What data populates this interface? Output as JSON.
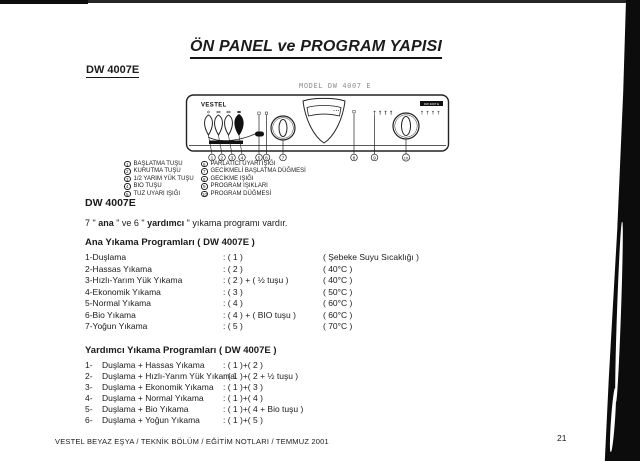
{
  "page": {
    "title": "ÖN PANEL ve PROGRAM YAPISI",
    "doc_model": "DW 4007E",
    "footer_text": "VESTEL BEYAZ EŞYA / TEKNİK BÖLÜM / EĞİTİM NOTLARI / TEMMUZ 2001",
    "page_number": "21"
  },
  "panel_figure": {
    "model_label": "MODEL DW 4007 E",
    "brand": "VESTEL",
    "badge": "DW 4007 E",
    "callout_numbers": [
      "1",
      "2",
      "3",
      "4",
      "5",
      "6",
      "7",
      "8",
      "9",
      "10"
    ],
    "legend_left": [
      {
        "num": "1",
        "label": "BAŞLATMA TUŞU"
      },
      {
        "num": "2",
        "label": "KURUTMA TUŞU"
      },
      {
        "num": "3",
        "label": "1/2 YARIM YÜK TUŞU"
      },
      {
        "num": "4",
        "label": "BIO TUŞU"
      },
      {
        "num": "5",
        "label": "TUZ UYARI IŞIĞI"
      }
    ],
    "legend_right": [
      {
        "num": "6",
        "label": "PARLATICI UYARI IŞIĞI"
      },
      {
        "num": "7",
        "label": "GECİKMELİ BAŞLATMA DÜĞMESİ"
      },
      {
        "num": "8",
        "label": "GECİKME IŞIĞI"
      },
      {
        "num": "9",
        "label": "PROGRAM IŞIKLARI"
      },
      {
        "num": "10",
        "label": "PROGRAM DÜĞMESİ"
      }
    ]
  },
  "intro": {
    "model": "DW 4007E",
    "line_parts": {
      "p1": "7 \" ",
      "b1": "ana",
      "p2": " \" ve 6 \" ",
      "b2": "yardımcı",
      "p3": " \"  yıkama programı vardır."
    }
  },
  "main_programs": {
    "heading": "Ana Yıkama Programları   ( DW 4007E )",
    "rows": [
      {
        "name": "1-Duşlama",
        "code": ": ( 1 )",
        "temp": "( Şebeke Suyu Sıcaklığı )"
      },
      {
        "name": "2-Hassas Yıkama",
        "code": ": ( 2 )",
        "temp": "( 40°C )"
      },
      {
        "name": "3-Hızlı-Yarım Yük Yıkama",
        "code": ": ( 2 ) + ( ½  tuşu )",
        "temp": "( 40°C )"
      },
      {
        "name": "4-Ekonomik Yıkama",
        "code": ": ( 3 )",
        "temp": "( 50°C )"
      },
      {
        "name": "5-Normal Yıkama",
        "code": ": ( 4 )",
        "temp": "( 60°C )"
      },
      {
        "name": "6-Bio Yıkama",
        "code": ": ( 4 ) + ( BIO tuşu )",
        "temp": "( 60°C )"
      },
      {
        "name": "7-Yoğun Yıkama",
        "code": ": ( 5 )",
        "temp": " ( 70°C )"
      }
    ]
  },
  "aux_programs": {
    "heading": "Yardımcı Yıkama Programları  ( DW 4007E )",
    "rows": [
      {
        "num": "1-",
        "name": "Duşlama + Hassas Yıkama",
        "code": ": ( 1 )+( 2 )"
      },
      {
        "num": "2-",
        "name": "Duşlama + Hızlı-Yarım Yük Yıkama",
        "code": ": ( 1 )+( 2 + ½  tuşu )"
      },
      {
        "num": "3-",
        "name": "Duşlama + Ekonomik Yıkama",
        "code": ": ( 1 )+( 3 )"
      },
      {
        "num": "4-",
        "name": "Duşlama + Normal Yıkama",
        "code": ": ( 1 )+( 4 )"
      },
      {
        "num": "5-",
        "name": "Duşlama + Bio Yıkama",
        "code": ": ( 1 )+( 4  + Bio  tuşu )"
      },
      {
        "num": "6-",
        "name": "Duşlama + Yoğun  Yıkama",
        "code": ": ( 1 )+( 5 )"
      }
    ]
  },
  "colors": {
    "ink": "#1b1b1b",
    "scan_black": "#0c0c0c",
    "label_gray": "#8f8f8f",
    "paper": "#ffffff"
  }
}
